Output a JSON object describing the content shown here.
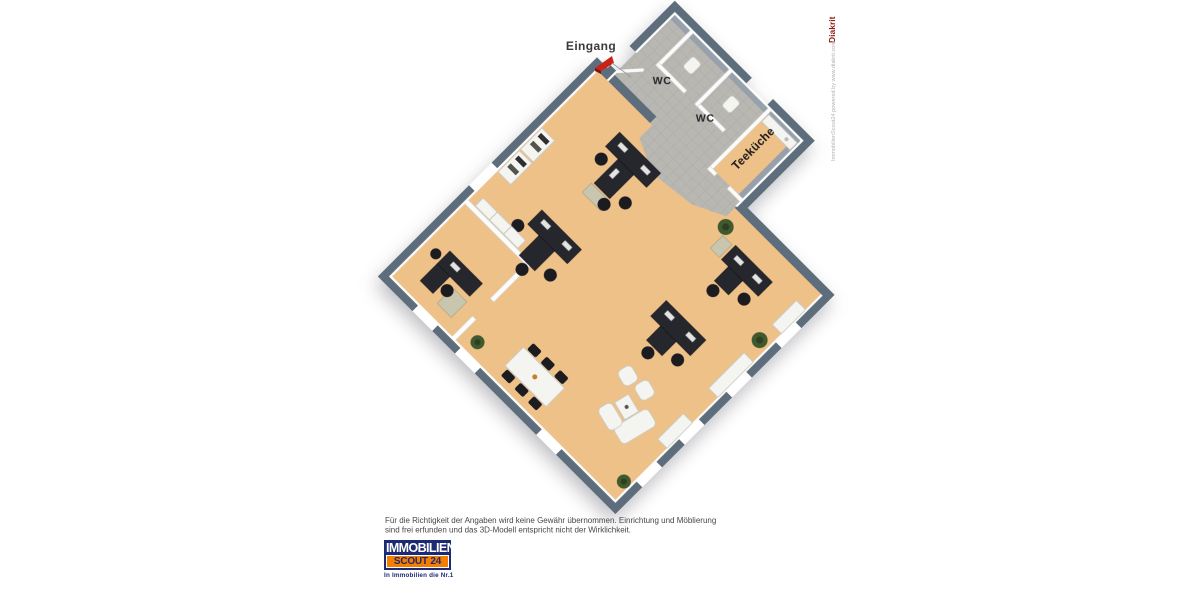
{
  "plan": {
    "labels": {
      "entrance": "Eingang",
      "wc1": "WC",
      "wc2": "WC",
      "kitchen": "Teeküche"
    }
  },
  "disclaimer": {
    "line1": "Für die Richtigkeit der Angaben wird keine Gewähr übernommen. Einrichtung und Möblierung",
    "line2": "sind frei erfunden und das 3D-Modell entspricht nicht der Wirklichkeit."
  },
  "logo": {
    "line1": "IMMOBILIEN",
    "line2": "SCOUT 24",
    "tagline": "In Immobilien die Nr.1"
  },
  "watermark": {
    "brand": "Diakrit",
    "credit": "ImmobilienScout24 powered by www.diakrit.com"
  },
  "colors": {
    "wall": "#5e6d7c",
    "wall_face": "#97a1ab",
    "floor": "#eec189",
    "tile": "#b8b7b1",
    "tile_line": "#a9a8a2",
    "desk": "#26262d",
    "chair": "#1b1b20",
    "furniture_white": "#f4f4f1",
    "sideboard": "#c8c6ae",
    "plant": "#40592e",
    "arrow_red": "#cb2218",
    "leader": "#9aa0a5",
    "logo_navy": "#1c2a72",
    "logo_orange": "#f57d00",
    "diakrit_red": "#8e1a12",
    "disclaimer": "#474747",
    "text_muted": "#b3b3b3"
  }
}
